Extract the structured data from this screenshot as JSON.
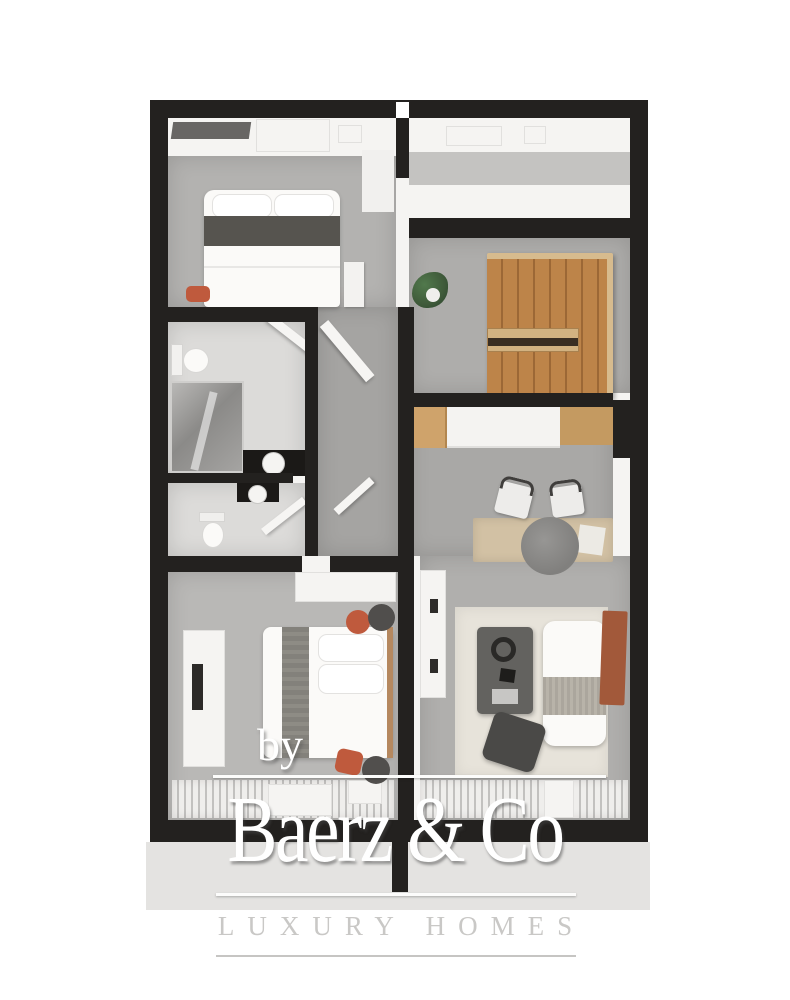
{
  "image_type": "3d-floorplan-render",
  "watermark": {
    "prefix": "by",
    "brand": "Baerz & Co",
    "tagline": "LUXURY HOMES"
  },
  "colors": {
    "wall": "#23211f",
    "floor_light": "#f5f4f2",
    "floor_gray": "#b3b2b0",
    "floor_gray_dark": "#a5a4a2",
    "floor_kitchen": "#a9a8a6",
    "floor_bed2": "#b9b8b6",
    "floor_living": "#b0afad",
    "floor_closet": "#aeadab",
    "floor_bath": "#dcdbd9",
    "entry_band": "#c4c3c1",
    "photo_strip": "#e4e3e1",
    "wood": "#bd8449",
    "wood_dark": "#9c6836",
    "wood_trim": "#d7bb8e",
    "terracotta": "#a2593a",
    "orange_accent": "#bf5a3d",
    "dark_furniture": "#504e4c",
    "bed_band": "#56544f",
    "bed_runner": "#8e8c85",
    "rug_beige": "#e7e3da",
    "rug_round": "#8b8a88",
    "plant_green": "#3f5a3a",
    "watermark_white": "#ffffff",
    "tagline_gray": "#c9c8c6"
  },
  "floorplan": {
    "rooms": [
      "bedroom-top",
      "entry-hall",
      "walk-in-closet",
      "bathroom",
      "toilet-room",
      "hallway",
      "kitchen-dining",
      "bedroom-bottom",
      "living-room",
      "balcony"
    ]
  }
}
